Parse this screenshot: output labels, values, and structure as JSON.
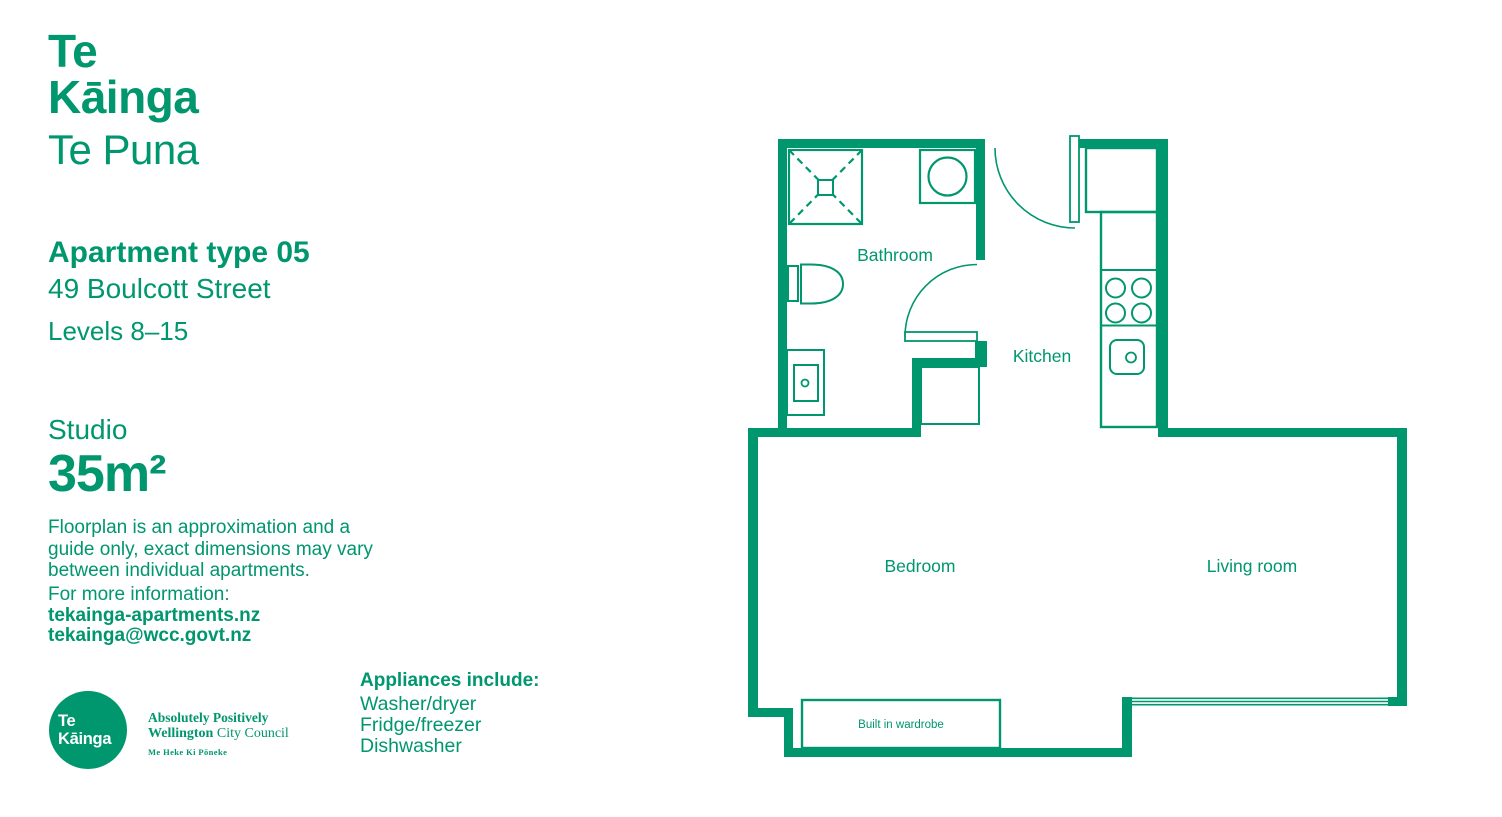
{
  "colors": {
    "brand_green": "#00966e",
    "background": "#ffffff"
  },
  "brand": {
    "logo_line1": "Te",
    "logo_line2": "Kāinga",
    "logo_sub": "Te Puna"
  },
  "apartment": {
    "type_heading": "Apartment type 05",
    "address": "49 Boulcott Street",
    "levels": "Levels 8–15",
    "layout": "Studio",
    "area": "35m²",
    "disclaimer_lines": [
      "Floorplan is an approximation and a",
      "guide only, exact dimensions may vary",
      "between individual apartments."
    ],
    "info_label": "For more information:",
    "website": "tekainga-apartments.nz",
    "email": "tekainga@wcc.govt.nz"
  },
  "appliances": {
    "heading": "Appliances include:",
    "items": [
      "Washer/dryer",
      "Fridge/freezer",
      "Dishwasher"
    ]
  },
  "footer_logo": {
    "circle_line1": "Te",
    "circle_line2": "Kāinga",
    "council_line1": "Absolutely Positively",
    "council_line2_bold": "Wellington",
    "council_line2_rest": " City Council",
    "council_line3": "Me Heke Ki Pōneke"
  },
  "floorplan": {
    "rooms": {
      "bathroom": "Bathroom",
      "kitchen": "Kitchen",
      "bedroom": "Bedroom",
      "living_room": "Living room"
    },
    "wardrobe_label": "Built in wardrobe"
  }
}
